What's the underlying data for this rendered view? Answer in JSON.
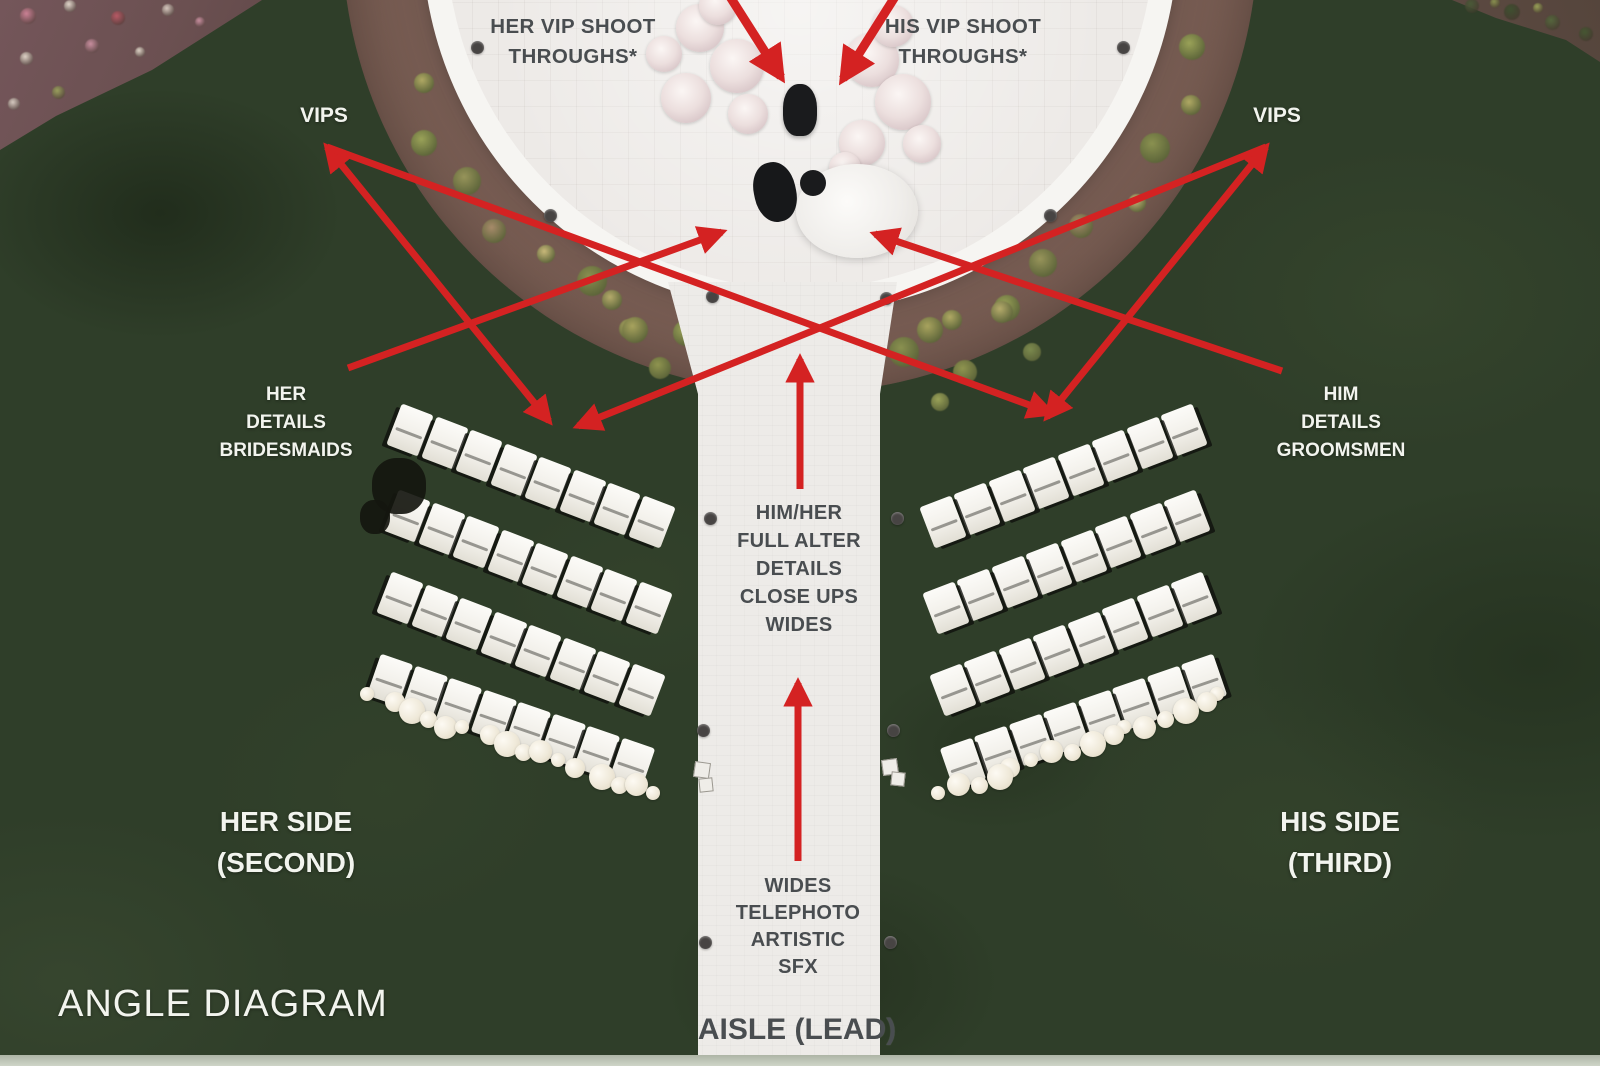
{
  "title": "ANGLE DIAGRAM",
  "labels": {
    "her_vip": "HER VIP SHOOT\nTHROUGHS*",
    "his_vip": "HIS VIP SHOOT\nTHROUGHS*",
    "vips_left": "VIPS",
    "vips_right": "VIPS",
    "her_details": "HER\nDETAILS\nBRIDESMAIDS",
    "him_details": "HIM\nDETAILS\nGROOMSMEN",
    "altar_shots": "HIM/HER\nFULL ALTER\nDETAILS\nCLOSE UPS\nWIDES",
    "far_shots": "WIDES\nTELEPHOTO\nARTISTIC\nSFX",
    "aisle_lead": "AISLE (LEAD)",
    "her_side": "HER SIDE\n(SECOND)",
    "his_side": "HIS SIDE\n(THIRD)",
    "angle_diagram": "ANGLE DIAGRAM"
  },
  "colors": {
    "arrow": "#d42222",
    "label_dark": "#494d50",
    "label_light": "#f2f4ee",
    "grass": "#2f3e29",
    "mulch": "#6e564e",
    "ring": "#f6f5f2",
    "circle": "#edeae7",
    "aisle": "#edebe8"
  },
  "arrows": [
    {
      "x1": 727,
      "y1": -8,
      "x2": 781,
      "y2": 77,
      "w": 9,
      "head": "end"
    },
    {
      "x1": 898,
      "y1": -8,
      "x2": 843,
      "y2": 79,
      "w": 9,
      "head": "end"
    },
    {
      "x1": 327,
      "y1": 147,
      "x2": 549,
      "y2": 421,
      "w": 7,
      "head": "both"
    },
    {
      "x1": 327,
      "y1": 147,
      "x2": 1051,
      "y2": 413,
      "w": 7,
      "head": "end"
    },
    {
      "x1": 1266,
      "y1": 147,
      "x2": 1047,
      "y2": 417,
      "w": 7,
      "head": "both"
    },
    {
      "x1": 1266,
      "y1": 147,
      "x2": 578,
      "y2": 426,
      "w": 7,
      "head": "end"
    },
    {
      "x1": 348,
      "y1": 368,
      "x2": 722,
      "y2": 232,
      "w": 7,
      "head": "end"
    },
    {
      "x1": 1282,
      "y1": 371,
      "x2": 875,
      "y2": 234,
      "w": 7,
      "head": "end"
    },
    {
      "x1": 800,
      "y1": 489,
      "x2": 800,
      "y2": 359,
      "w": 7,
      "head": "end"
    },
    {
      "x1": 798,
      "y1": 861,
      "x2": 798,
      "y2": 683,
      "w": 7,
      "head": "end"
    }
  ],
  "scene": {
    "ring_plants": {
      "cx": 800,
      "cy": -65,
      "start": 16,
      "end": 164,
      "step": 7.5,
      "radii": [
        408,
        426,
        414,
        430,
        404
      ],
      "sizes": [
        26,
        20,
        30,
        18,
        24,
        28
      ],
      "colors": [
        "#9aa258",
        "#b0a964",
        "#8a9150",
        "#c9b97a",
        "#a78b6a",
        "#97945a"
      ]
    },
    "extra_plants": [
      {
        "x": 635,
        "y": 330,
        "s": 26,
        "c": "#a8a35e"
      },
      {
        "x": 660,
        "y": 368,
        "s": 22,
        "c": "#8f944f"
      },
      {
        "x": 612,
        "y": 300,
        "s": 20,
        "c": "#b5ab6b"
      },
      {
        "x": 930,
        "y": 330,
        "s": 26,
        "c": "#a8a35e"
      },
      {
        "x": 965,
        "y": 372,
        "s": 24,
        "c": "#8f944f"
      },
      {
        "x": 1002,
        "y": 312,
        "s": 22,
        "c": "#b5ab6b"
      },
      {
        "x": 940,
        "y": 402,
        "s": 18,
        "c": "#9aa258"
      },
      {
        "x": 1032,
        "y": 352,
        "s": 18,
        "c": "#7c8a4e"
      }
    ],
    "bed_left_flowers": [
      {
        "x": 28,
        "y": 16,
        "s": 16,
        "c": "#cc8296"
      },
      {
        "x": 70,
        "y": 6,
        "s": 12,
        "c": "#e3d7cc"
      },
      {
        "x": 118,
        "y": 18,
        "s": 14,
        "c": "#b85a66"
      },
      {
        "x": 168,
        "y": 10,
        "s": 12,
        "c": "#d8c9c0"
      },
      {
        "x": 26,
        "y": 58,
        "s": 13,
        "c": "#e0d4c8"
      },
      {
        "x": 92,
        "y": 46,
        "s": 14,
        "c": "#c98fa0"
      },
      {
        "x": 58,
        "y": 92,
        "s": 13,
        "c": "#9aa05e"
      },
      {
        "x": 14,
        "y": 104,
        "s": 12,
        "c": "#d8ccc2"
      },
      {
        "x": 200,
        "y": 22,
        "s": 10,
        "c": "#c98fa0"
      },
      {
        "x": 140,
        "y": 52,
        "s": 10,
        "c": "#e0d4c8"
      }
    ],
    "bed_right_flowers": [
      {
        "x": 1472,
        "y": 6,
        "s": 14,
        "c": "#4a5a38"
      },
      {
        "x": 1512,
        "y": 12,
        "s": 16,
        "c": "#3f5030"
      },
      {
        "x": 1552,
        "y": 22,
        "s": 15,
        "c": "#55663d"
      },
      {
        "x": 1586,
        "y": 34,
        "s": 14,
        "c": "#465733"
      },
      {
        "x": 1495,
        "y": 3,
        "s": 10,
        "c": "#8a9150"
      },
      {
        "x": 1538,
        "y": 8,
        "s": 10,
        "c": "#9aa258"
      }
    ],
    "ring_dots": [
      {
        "x": 477,
        "y": 47
      },
      {
        "x": 550,
        "y": 215
      },
      {
        "x": 1123,
        "y": 47
      },
      {
        "x": 1050,
        "y": 215
      },
      {
        "x": 712,
        "y": 296
      },
      {
        "x": 886,
        "y": 298
      }
    ],
    "aisle_dots": [
      {
        "x": 710,
        "y": 518
      },
      {
        "x": 897,
        "y": 518
      },
      {
        "x": 703,
        "y": 730
      },
      {
        "x": 893,
        "y": 730
      },
      {
        "x": 705,
        "y": 942
      },
      {
        "x": 890,
        "y": 942
      }
    ],
    "speaker_squares": [
      {
        "x": 694,
        "y": 762,
        "s": 14,
        "r": 8
      },
      {
        "x": 699,
        "y": 778,
        "s": 12,
        "r": -6
      },
      {
        "x": 882,
        "y": 759,
        "s": 14,
        "r": -8
      },
      {
        "x": 891,
        "y": 772,
        "s": 12,
        "r": 6
      }
    ],
    "chair_rows": [
      {
        "side": "left",
        "x": 410,
        "y": 430,
        "dx": 34.5,
        "dy": 13.2,
        "count": 8,
        "rot": 21
      },
      {
        "side": "left",
        "x": 407,
        "y": 516,
        "dx": 34.5,
        "dy": 13.2,
        "count": 8,
        "rot": 21
      },
      {
        "side": "left",
        "x": 400,
        "y": 598,
        "dx": 34.5,
        "dy": 13.2,
        "count": 8,
        "rot": 21
      },
      {
        "side": "left",
        "x": 390,
        "y": 680,
        "dx": 34.5,
        "dy": 12.0,
        "count": 8,
        "rot": 19
      },
      {
        "side": "right",
        "x": 1184,
        "y": 430,
        "dx": -34.5,
        "dy": 13.2,
        "count": 8,
        "rot": -21
      },
      {
        "side": "right",
        "x": 1187,
        "y": 516,
        "dx": -34.5,
        "dy": 13.2,
        "count": 8,
        "rot": -21
      },
      {
        "side": "right",
        "x": 1194,
        "y": 598,
        "dx": -34.5,
        "dy": 13.2,
        "count": 8,
        "rot": -21
      },
      {
        "side": "right",
        "x": 1204,
        "y": 680,
        "dx": -34.5,
        "dy": 12.0,
        "count": 8,
        "rot": -19
      }
    ],
    "garlands": [
      {
        "x1": 372,
        "y1": 698,
        "x2": 655,
        "y2": 794,
        "count": 16
      },
      {
        "x1": 1222,
        "y1": 698,
        "x2": 940,
        "y2": 794,
        "count": 16
      }
    ],
    "altar_flowers": [
      {
        "x": 700,
        "y": 28,
        "s": 48
      },
      {
        "x": 737,
        "y": 66,
        "s": 54
      },
      {
        "x": 686,
        "y": 98,
        "s": 50
      },
      {
        "x": 748,
        "y": 114,
        "s": 40
      },
      {
        "x": 664,
        "y": 54,
        "s": 36
      },
      {
        "x": 718,
        "y": 6,
        "s": 38
      },
      {
        "x": 872,
        "y": 60,
        "s": 54
      },
      {
        "x": 903,
        "y": 102,
        "s": 56
      },
      {
        "x": 862,
        "y": 143,
        "s": 46
      },
      {
        "x": 922,
        "y": 144,
        "s": 38
      },
      {
        "x": 893,
        "y": 26,
        "s": 42
      },
      {
        "x": 845,
        "y": 168,
        "s": 32
      }
    ],
    "figures": {
      "officiant": {
        "x": 783,
        "y": 84,
        "w": 34,
        "h": 52,
        "rot": 0
      },
      "groom": {
        "x": 754,
        "y": 162,
        "w": 42,
        "h": 60,
        "rot": -12
      },
      "bride_dress": {
        "x": 796,
        "y": 164,
        "w": 122,
        "h": 94
      },
      "bride_head": {
        "x": 800,
        "y": 170,
        "s": 26
      },
      "black_object": [
        {
          "x": 372,
          "y": 458,
          "w": 54,
          "h": 56
        },
        {
          "x": 360,
          "y": 500,
          "w": 30,
          "h": 34
        }
      ]
    }
  }
}
